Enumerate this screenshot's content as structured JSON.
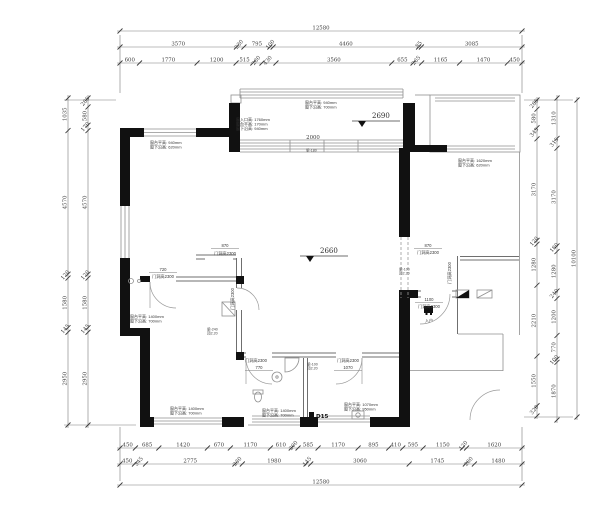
{
  "drawing": {
    "type": "residential floor plan",
    "overall_width_mm": "12580",
    "overall_height_mm": "10100"
  },
  "dim_chains": {
    "top_total": [
      "12580"
    ],
    "top_major": [
      "3570",
      "230",
      "795",
      "100",
      "4460",
      "85",
      "3085"
    ],
    "top_minor": [
      "600",
      "1770",
      "1200",
      "515",
      "280",
      "430",
      "3560",
      "655",
      "265",
      "1165",
      "1470",
      "450"
    ],
    "bottom_minor": [
      "450",
      "685",
      "1420",
      "670",
      "1170",
      "610",
      "200",
      "585",
      "1170",
      "895",
      "410",
      "595",
      "1150",
      "120",
      "1620"
    ],
    "bottom_major": [
      "450",
      "345",
      "2775",
      "230",
      "1980",
      "145",
      "3060",
      "1745",
      "280",
      "1480"
    ],
    "bottom_total": [
      "12580"
    ],
    "left_outer": [
      "1035",
      "4570",
      "120",
      "1580",
      "145",
      "2950"
    ],
    "left_inner": [
      "285",
      "580",
      "170",
      "4570",
      "120",
      "1580",
      "145",
      "2950"
    ],
    "right_inner": [
      "285",
      "580",
      "345",
      "3170",
      "120",
      "1280",
      "2210",
      "1550",
      "320"
    ],
    "right_mid": [
      "1310",
      "315",
      "3170",
      "180",
      "1280",
      "240",
      "1200",
      "770",
      "100",
      "1870"
    ],
    "right_total": [
      "10100"
    ]
  },
  "levels": [
    {
      "id": "balcony",
      "value": "2690"
    },
    {
      "id": "living",
      "value": "2660"
    }
  ],
  "interior_dims": {
    "balcony_slider_width": "2000"
  },
  "door_height_label": "门洞高2300",
  "doors": [
    {
      "width": "870"
    },
    {
      "width": "720"
    },
    {
      "width": "770"
    },
    {
      "width": "1070"
    },
    {
      "width": "870"
    },
    {
      "width": "1100"
    }
  ],
  "annotations": [
    {
      "id": "balcony-top",
      "lines": [
        "窗台平高: 940mm",
        "窗下沿高: 700mm"
      ]
    },
    {
      "id": "balcony-left",
      "lines": [
        "窗入口高: 1760mm",
        "窗台平高: 170mm",
        "窗下沿高: 940mm"
      ]
    },
    {
      "id": "living-topleft",
      "lines": [
        "窗台平高: 940mm",
        "窗下沿高: 620mm"
      ]
    },
    {
      "id": "right-bedroom",
      "lines": [
        "窗台平高: 1620mm",
        "窗下沿高: 620mm"
      ]
    },
    {
      "id": "left-window",
      "lines": [
        "窗台平高: 1400mm",
        "窗下沿高: 700mm"
      ]
    },
    {
      "id": "bedroom-bottom",
      "lines": [
        "窗台平高: 1400mm",
        "窗下沿高: 700mm"
      ]
    },
    {
      "id": "bath-bottom",
      "lines": [
        "窗台平高: 1400mm",
        "窗下沿高: 700mm"
      ]
    },
    {
      "id": "kitchen-bottom",
      "lines": [
        "窗台平高: 1070mm",
        "窗下沿高: 950mm"
      ]
    }
  ],
  "beam_notes": [
    {
      "lines": [
        "梁-100",
        "顶2.20"
      ]
    },
    {
      "lines": [
        "梁-100",
        "顶2.20"
      ]
    },
    {
      "lines": [
        "梁-240",
        "顶2.20"
      ]
    },
    {
      "lines": [
        "梁-180"
      ]
    }
  ],
  "entry": {
    "label": "入户"
  },
  "codes": {
    "d15": "D15"
  },
  "colors": {
    "wall": "#111111",
    "thin_line": "#8f8f8f",
    "dimension": "#3f3f3f"
  }
}
